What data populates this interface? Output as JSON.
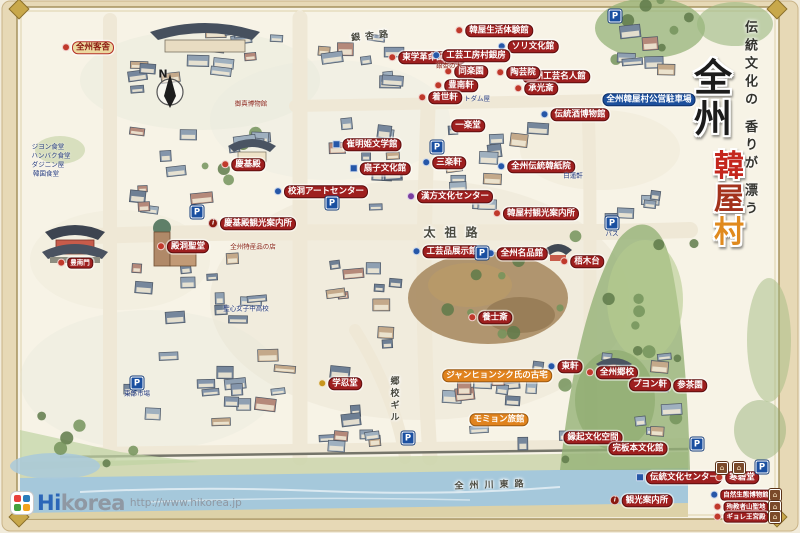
{
  "palette": {
    "chip_red": "#9e1f1f",
    "chip_blue": "#1c4f9c",
    "chip_orange": "#e0831e",
    "chip_gold_bg": "#ecd9a0",
    "chip_gold_text": "#8a1a10",
    "parking_blue": "#1a4fa0",
    "house_brown": "#7a4a2a",
    "title_black": "#1c1c1c"
  },
  "title": {
    "subtitle": "伝統文化の 香りが 漂う",
    "main": "全州",
    "sub_chars": [
      {
        "ch": "韓",
        "color": "#c4261d"
      },
      {
        "ch": "屋",
        "color": "#a3321c"
      },
      {
        "ch": "村",
        "color": "#e08a1e"
      }
    ]
  },
  "logo": {
    "hi": "Hi",
    "korea": "korea",
    "url": "http://www.hikorea.jp"
  },
  "map": {
    "labels": [
      {
        "text": "全州客舎",
        "x": 88,
        "y": 48,
        "type": "gold",
        "dot": "red"
      },
      {
        "text": "豊南門",
        "x": 75,
        "y": 263,
        "small": true,
        "dot": "red"
      },
      {
        "text": "殿洞聖堂",
        "x": 183,
        "y": 247,
        "dot": "red"
      },
      {
        "text": "慶基殿",
        "x": 243,
        "y": 165,
        "dot": "red"
      },
      {
        "text": "慶基殿観光案内所",
        "x": 252,
        "y": 224,
        "dot": "info"
      },
      {
        "text": "校洞アートセンター",
        "x": 321,
        "y": 192,
        "dot": "blue"
      },
      {
        "text": "崔明姫文学館",
        "x": 367,
        "y": 145,
        "dot": "bluesq"
      },
      {
        "text": "扇子文化館",
        "x": 380,
        "y": 169,
        "dot": "bluesq"
      },
      {
        "text": "東学革命記念館",
        "x": 427,
        "y": 58,
        "dot": "red"
      },
      {
        "text": "韓屋生活体験館",
        "x": 494,
        "y": 31,
        "dot": "red"
      },
      {
        "text": "ソリ文化館",
        "x": 528,
        "y": 47,
        "dot": "blue"
      },
      {
        "text": "工芸工房村銀房",
        "x": 471,
        "y": 56,
        "dot": "blue"
      },
      {
        "text": "全州工芸名人館",
        "x": 551,
        "y": 77,
        "dot": "blue"
      },
      {
        "text": "全州韓屋村公営駐車場",
        "x": 649,
        "y": 100,
        "type": "blue"
      },
      {
        "text": "伝統酒博物館",
        "x": 575,
        "y": 115,
        "dot": "blue"
      },
      {
        "text": "同楽園",
        "x": 466,
        "y": 72,
        "dot": "red"
      },
      {
        "text": "陶芸院",
        "x": 518,
        "y": 73,
        "dot": "red"
      },
      {
        "text": "豊南軒",
        "x": 456,
        "y": 86,
        "dot": "red"
      },
      {
        "text": "承光斎",
        "x": 536,
        "y": 89,
        "dot": "red"
      },
      {
        "text": "着世軒",
        "x": 440,
        "y": 98,
        "dot": "red"
      },
      {
        "text": "一楽堂",
        "x": 468,
        "y": 126
      },
      {
        "text": "三楽軒",
        "x": 444,
        "y": 163,
        "dot": "blue"
      },
      {
        "text": "漢方文化センター",
        "x": 450,
        "y": 197,
        "dot": "purple"
      },
      {
        "text": "全州伝統韓紙院",
        "x": 536,
        "y": 167,
        "dot": "blue"
      },
      {
        "text": "韓屋村観光案内所",
        "x": 536,
        "y": 214,
        "dot": "red"
      },
      {
        "text": "工芸品展示館",
        "x": 447,
        "y": 252,
        "dot": "blue"
      },
      {
        "text": "全州名品館",
        "x": 517,
        "y": 254,
        "dot": "blue"
      },
      {
        "text": "梧木台",
        "x": 582,
        "y": 262,
        "dot": "red"
      },
      {
        "text": "養士斎",
        "x": 490,
        "y": 318,
        "dot": "red"
      },
      {
        "text": "学忍堂",
        "x": 340,
        "y": 384,
        "dot": "gold"
      },
      {
        "text": "ジャンヒョンシク氏の古宅",
        "x": 497,
        "y": 376,
        "type": "orange"
      },
      {
        "text": "モミョン旅館",
        "x": 499,
        "y": 420,
        "type": "orange"
      },
      {
        "text": "東軒",
        "x": 565,
        "y": 367,
        "dot": "blue"
      },
      {
        "text": "全州郷校",
        "x": 612,
        "y": 373,
        "dot": "red"
      },
      {
        "text": "プヨン軒",
        "x": 650,
        "y": 385
      },
      {
        "text": "参茶園",
        "x": 690,
        "y": 386
      },
      {
        "text": "縁起文化空間",
        "x": 593,
        "y": 438
      },
      {
        "text": "完板本文化館",
        "x": 638,
        "y": 449
      },
      {
        "text": "伝統文化センター",
        "x": 679,
        "y": 478,
        "dot": "bluesq"
      },
      {
        "text": "観光案内所",
        "x": 641,
        "y": 501,
        "dot": "info"
      },
      {
        "text": "寒碧堂",
        "x": 737,
        "y": 478,
        "dot": "red"
      },
      {
        "text": "自然生態博物館",
        "x": 741,
        "y": 495,
        "small": true,
        "dot": "blue"
      },
      {
        "text": "殉教者山聖地",
        "x": 741,
        "y": 507,
        "small": true,
        "dot": "red"
      },
      {
        "text": "ギョレ王宮殿",
        "x": 741,
        "y": 517,
        "small": true,
        "dot": "red"
      }
    ],
    "roads": [
      {
        "text": "太祖路",
        "x": 455,
        "y": 232,
        "size": 12,
        "spacing": 9,
        "angle": 0
      },
      {
        "text": "銀杏路",
        "x": 372,
        "y": 35,
        "size": 9,
        "spacing": 5,
        "angle": -6
      },
      {
        "text": "郷校ギル",
        "x": 394,
        "y": 400,
        "size": 9,
        "spacing": 3,
        "vert": true
      },
      {
        "text": "全州川東路",
        "x": 492,
        "y": 484,
        "size": 9,
        "spacing": 6,
        "angle": -2
      }
    ],
    "tiny": [
      {
        "text": "ジヨン食堂",
        "x": 48,
        "y": 147,
        "c": "blue"
      },
      {
        "text": "ハンバク食堂",
        "x": 51,
        "y": 156,
        "c": "blue"
      },
      {
        "text": "ダジニン屋",
        "x": 48,
        "y": 165,
        "c": "blue"
      },
      {
        "text": "韓国食堂",
        "x": 46,
        "y": 174,
        "c": "blue"
      },
      {
        "text": "聖心女子中高校",
        "x": 246,
        "y": 309,
        "c": "blue"
      },
      {
        "text": "東部市場",
        "x": 137,
        "y": 394,
        "c": "blue"
      },
      {
        "text": "バス",
        "x": 612,
        "y": 234,
        "c": "blue"
      },
      {
        "text": "トダム屋",
        "x": 477,
        "y": 99,
        "c": "blue"
      },
      {
        "text": "白蓮軒",
        "x": 573,
        "y": 176,
        "c": "blue"
      },
      {
        "text": "御真博物館",
        "x": 251,
        "y": 104,
        "c": "red"
      },
      {
        "text": "銀杏の木",
        "x": 449,
        "y": 66,
        "c": "red"
      },
      {
        "text": "全州特産品の店",
        "x": 253,
        "y": 247,
        "c": "red"
      }
    ],
    "parking": {
      "glyph": "P",
      "spots": [
        [
          615,
          16
        ],
        [
          437,
          147
        ],
        [
          197,
          212
        ],
        [
          332,
          203
        ],
        [
          482,
          253
        ],
        [
          612,
          223
        ],
        [
          137,
          383
        ],
        [
          408,
          438
        ],
        [
          697,
          444
        ],
        [
          762,
          467
        ]
      ]
    },
    "houses": {
      "glyph": "⌂",
      "spots": [
        [
          722,
          468
        ],
        [
          739,
          468
        ],
        [
          775,
          495
        ],
        [
          775,
          507
        ],
        [
          775,
          517
        ]
      ]
    },
    "compass": {
      "letter": "N",
      "x": 163,
      "y": 74
    }
  }
}
